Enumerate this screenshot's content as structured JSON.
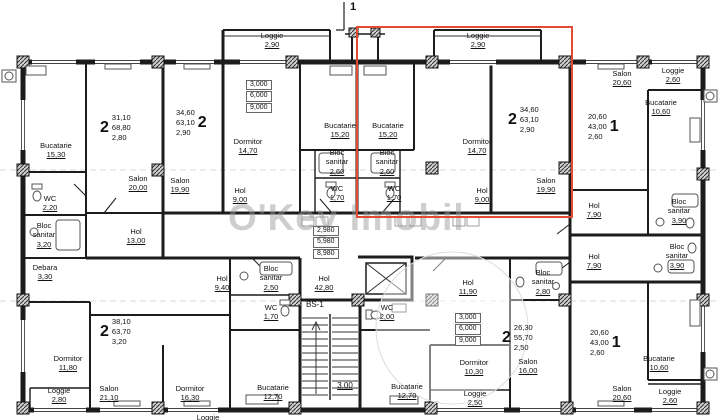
{
  "watermark": {
    "text": "O'Key Imobil"
  },
  "colors": {
    "highlight": "#e04b33",
    "wall": "#1c1c1c"
  },
  "marks": {
    "section": "1",
    "stair": "BS-1",
    "stair_width": "3.00"
  },
  "levels": {
    "left": [
      "3,000",
      "6,000",
      "9,000"
    ],
    "center": [
      "2,980",
      "5,980",
      "8,980"
    ],
    "right": [
      "3,000",
      "6,000",
      "9,000"
    ]
  },
  "units": [
    {
      "rooms": "2",
      "living": "31,10",
      "total": "68,80",
      "extra": "2,80"
    },
    {
      "rooms": "2",
      "living": "34,60",
      "total": "63,10",
      "extra": "2,90"
    },
    {
      "rooms": "2",
      "living": "34,60",
      "total": "63,10",
      "extra": "2,90",
      "highlighted": true
    },
    {
      "rooms": "1",
      "living": "20,60",
      "total": "43,00",
      "extra": "2,60"
    },
    {
      "rooms": "2",
      "living": "38,10",
      "total": "63,70",
      "extra": "3,20"
    },
    {
      "rooms": "2",
      "living": "26,30",
      "total": "55,70",
      "extra": "2,50"
    },
    {
      "rooms": "1",
      "living": "20,60",
      "total": "43,00",
      "extra": "2,60"
    }
  ],
  "rooms": [
    {
      "name": "Loggie",
      "area": "2,90"
    },
    {
      "name": "Loggie",
      "area": "2,90"
    },
    {
      "name": "Salon",
      "area": "20,60"
    },
    {
      "name": "Loggie",
      "area": "2,60"
    },
    {
      "name": "Bucatarie",
      "area": "10,60"
    },
    {
      "name": "Bucatarie",
      "area": "15,30"
    },
    {
      "name": "Salon",
      "area": "20,00"
    },
    {
      "name": "Salon",
      "area": "19,90"
    },
    {
      "name": "Dormitor",
      "area": "14,70"
    },
    {
      "name": "Bucatarie",
      "area": "15,20"
    },
    {
      "name": "Bucatarie",
      "area": "15,20"
    },
    {
      "name": "Bloc sanitar",
      "area": "2,60"
    },
    {
      "name": "Bloc sanitar",
      "area": "2,60"
    },
    {
      "name": "WC",
      "area": "1,70"
    },
    {
      "name": "WC",
      "area": "1,70"
    },
    {
      "name": "Dormitor",
      "area": "14,70"
    },
    {
      "name": "Hol",
      "area": "9,00"
    },
    {
      "name": "Hol",
      "area": "9,00"
    },
    {
      "name": "Salon",
      "area": "19,90"
    },
    {
      "name": "WC",
      "area": "2,20"
    },
    {
      "name": "Bloc sanitar",
      "area": "3,20"
    },
    {
      "name": "Debara",
      "area": "3,30"
    },
    {
      "name": "Hol",
      "area": "13,00"
    },
    {
      "name": "Hol",
      "area": "42,80"
    },
    {
      "name": "Hol",
      "area": "9,40"
    },
    {
      "name": "Bloc sanitar",
      "area": "2,50"
    },
    {
      "name": "WC",
      "area": "1,70"
    },
    {
      "name": "Dormitor",
      "area": "11,80"
    },
    {
      "name": "Loggie",
      "area": "2,80"
    },
    {
      "name": "Salon",
      "area": "21,10"
    },
    {
      "name": "Dormitor",
      "area": "16,30"
    },
    {
      "name": "Bucatarie",
      "area": "12,70"
    },
    {
      "name": "Bucatarie",
      "area": "12,70"
    },
    {
      "name": "Hol",
      "area": "11,90"
    },
    {
      "name": "Bloc sanitar",
      "area": "2,80"
    },
    {
      "name": "Dormitor",
      "area": "10,30"
    },
    {
      "name": "Salon",
      "area": "16,00"
    },
    {
      "name": "Loggie",
      "area": "2,50"
    },
    {
      "name": "Hol",
      "area": "7,90"
    },
    {
      "name": "Bloc sanitar",
      "area": "3,90"
    },
    {
      "name": "Hol",
      "area": "7,90"
    },
    {
      "name": "Bloc sanitar",
      "area": "3,90"
    },
    {
      "name": "Bucatarie",
      "area": "10,60"
    },
    {
      "name": "Salon",
      "area": "20,60"
    },
    {
      "name": "Loggie",
      "area": "2,60"
    },
    {
      "name": "WC",
      "area": "2,00"
    },
    {
      "name": "Loggie",
      "area": ""
    }
  ]
}
